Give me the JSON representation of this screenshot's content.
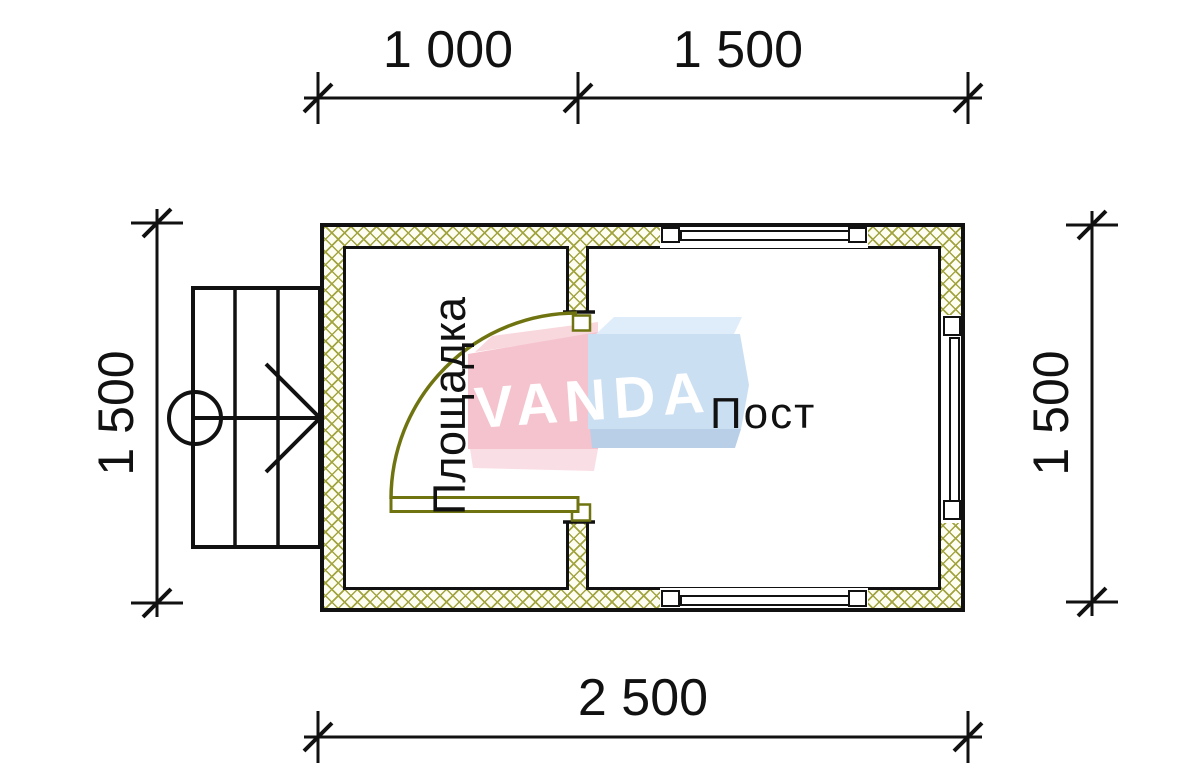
{
  "drawing_type": "floor-plan",
  "watermark": {
    "text": "VANDA"
  },
  "rooms": {
    "left": "Площадка",
    "right": "Пост"
  },
  "dims": {
    "top_left": "1 000",
    "top_right": "1 500",
    "bottom": "2 500",
    "left": "1 500",
    "right": "1 500"
  },
  "colors": {
    "wall_hatch": "#a2a440",
    "door": "#6f7410",
    "line": "#111111",
    "logo_pink": "#f5c3cd",
    "logo_blue": "#cbdff2"
  }
}
